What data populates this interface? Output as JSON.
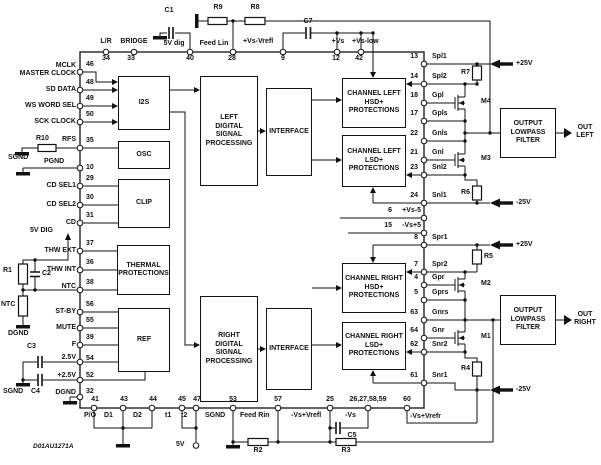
{
  "figure_code": "D01AU1271A",
  "blocks": {
    "i2s": "I2S",
    "osc": "OSC",
    "clip": "CLIP",
    "thermal": "THERMAL\nPROTECTIONS",
    "ref": "REF",
    "left_dsp": "LEFT\nDIGITAL\nSIGNAL\nPROCESSING",
    "interface_left": "INTERFACE",
    "ch_left_hsd": "CHANNEL LEFT\nHSD+\nPROTECTIONS",
    "ch_left_lsd": "CHANNEL LEFT\nLSD+\nPROTECTIONS",
    "right_dsp": "RIGHT\nDIGITAL\nSIGNAL\nPROCESSING",
    "interface_right": "INTERFACE",
    "ch_right_hsd": "CHANNEL RIGHT\nHSD+\nPROTECTIONS",
    "ch_right_lsd": "CHANNEL RIGHT\nLSD+\nPROTECTIONS",
    "out_filter_left": "OUTPUT\nLOWPASS\nFILTER",
    "out_filter_right": "OUTPUT\nLOWPASS\nFILTER"
  },
  "pins": {
    "top": [
      {
        "label": "L/R",
        "num": "34"
      },
      {
        "label": "BRIDGE",
        "num": "33"
      },
      {
        "label": "5V dig",
        "num": "40"
      },
      {
        "label": "Feed Lin",
        "num": "28"
      },
      {
        "label": "+Vs-Vrefl",
        "num": "9"
      },
      {
        "label": "+Vs",
        "num": "12"
      },
      {
        "label": "+Vs-low",
        "num": "42"
      }
    ],
    "left": [
      {
        "label": "MCLK\nMASTER CLOCK",
        "num": "46"
      },
      {
        "label": "SD DATA",
        "num": "48"
      },
      {
        "label": "WS WORD SEL",
        "num": "49"
      },
      {
        "label": "SCK CLOCK",
        "num": "50"
      },
      {
        "label": "RFS",
        "num": "35"
      },
      {
        "label": "PGND",
        "num": "10"
      },
      {
        "label": "CD SEL1",
        "num": "29"
      },
      {
        "label": "CD SEL2",
        "num": "30"
      },
      {
        "label": "CD",
        "num": "31"
      },
      {
        "label": "THW EXT",
        "num": "37"
      },
      {
        "label": "THW INT",
        "num": "36"
      },
      {
        "label": "NTC",
        "num": "38"
      },
      {
        "label": "ST-BY",
        "num": "56"
      },
      {
        "label": "MUTE",
        "num": "55"
      },
      {
        "label": "F",
        "num": "39"
      },
      {
        "label": "2.5V",
        "num": "54"
      },
      {
        "label": "+2.5V",
        "num": "52"
      },
      {
        "label": "DGND",
        "num": "32"
      }
    ],
    "right": [
      {
        "label": "Spl1",
        "num": "13"
      },
      {
        "label": "Spl2",
        "num": "14"
      },
      {
        "label": "Gpl",
        "num": "18"
      },
      {
        "label": "Gpls",
        "num": "17"
      },
      {
        "label": "Gnls",
        "num": "22"
      },
      {
        "label": "Gnl",
        "num": "21"
      },
      {
        "label": "Snl2",
        "num": "23"
      },
      {
        "label": "Snl1",
        "num": "24"
      },
      {
        "label": "+Vs-5",
        "num": "6"
      },
      {
        "label": "-Vs+5",
        "num": "15"
      },
      {
        "label": "Spr1",
        "num": "8"
      },
      {
        "label": "Spr2",
        "num": "7"
      },
      {
        "label": "Gpr",
        "num": "4"
      },
      {
        "label": "Gprs",
        "num": "5"
      },
      {
        "label": "Gnrs",
        "num": "63"
      },
      {
        "label": "Gnr",
        "num": "64"
      },
      {
        "label": "Snr2",
        "num": "62"
      },
      {
        "label": "Snr1",
        "num": "61"
      }
    ],
    "bottom": [
      {
        "label": "P/O",
        "num": "41"
      },
      {
        "label": "D1",
        "num": "43"
      },
      {
        "label": "D2",
        "num": "44"
      },
      {
        "label": "t1",
        "num": "45"
      },
      {
        "label": "t2",
        "num": "47"
      },
      {
        "label": "SGND",
        "num": "53"
      },
      {
        "label": "Feed Rin",
        "num": "57"
      },
      {
        "label": "-Vs+Vrefl",
        "num": "25"
      },
      {
        "label": "-Vs",
        "num": "26,27,58,59"
      },
      {
        "label": "-Vs+Vrefr",
        "num": "60"
      }
    ]
  },
  "components": {
    "c1": "C1",
    "c2": "C2",
    "c3": "C3",
    "c4": "C4",
    "c5": "C5",
    "c7": "C7",
    "r1": "R1",
    "r2": "R2",
    "r3": "R3",
    "r4": "R4",
    "r5": "R5",
    "r6": "R6",
    "r7": "R7",
    "r8": "R8",
    "r9": "R9",
    "r10": "R10",
    "m1": "M1",
    "m2": "M2",
    "m3": "M3",
    "m4": "M4",
    "ntc": "NTC"
  },
  "grounds": {
    "sgnd_rfs": "SGND",
    "sgnd_caps": "SGND",
    "dgnd_ntc": "DGND"
  },
  "supply": {
    "p25": "+25V",
    "n25": "-25V",
    "v5dig": "5V DIG",
    "v5": "5V"
  },
  "outputs": {
    "out_left": "OUT\nLEFT",
    "out_right": "OUT\nRIGHT"
  }
}
